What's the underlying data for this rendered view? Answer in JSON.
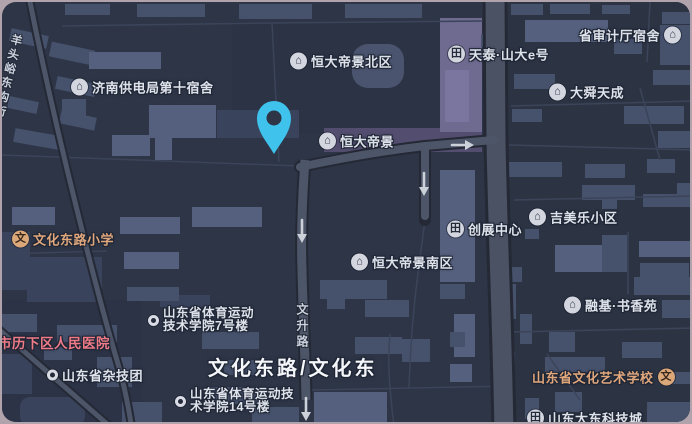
{
  "colors": {
    "frame": "#b1a3ab",
    "map_background": "#2d3547",
    "pin": "#3fc2ec",
    "default_label": "#dee2ea",
    "orange_label": "#e0a77d",
    "pink_label": "#ef7b87"
  },
  "icons": {
    "house": "⌂",
    "building": "田",
    "school": "文"
  },
  "pois": [
    {
      "name": "jinan-power-bureau-dorm",
      "lines": [
        "济南供电局第十宿舍"
      ],
      "icon": "house"
    },
    {
      "name": "hengda-dijing-north",
      "lines": [
        "恒大帝景北区"
      ],
      "icon": "house"
    },
    {
      "name": "tiantai-shanda-e",
      "lines": [
        "天泰·山大e号"
      ],
      "icon": "building"
    },
    {
      "name": "audit-office-dorm",
      "lines": [
        "省审计厅宿舍"
      ],
      "icon": "house",
      "icon_side": "right"
    },
    {
      "name": "dashun-tiancheng",
      "lines": [
        "大舜天成"
      ],
      "icon": "house"
    },
    {
      "name": "hengda-dijing",
      "lines": [
        "恒大帝景"
      ],
      "icon": "house"
    },
    {
      "name": "chuangzhan-center",
      "lines": [
        "创展中心"
      ],
      "icon": "building"
    },
    {
      "name": "jimeile-community",
      "lines": [
        "吉美乐小区"
      ],
      "icon": "house"
    },
    {
      "name": "wenhua-east-road-primary-school",
      "lines": [
        "文化东路小学"
      ],
      "icon": "school",
      "color": "orange"
    },
    {
      "name": "hengda-dijing-south",
      "lines": [
        "恒大帝景南区"
      ],
      "icon": "house"
    },
    {
      "name": "rongji-shuxiangyuan",
      "lines": [
        "融基·书香苑"
      ],
      "icon": "house"
    },
    {
      "name": "lixia-district-peoples-hospital",
      "lines": [
        "市历下区人民医院"
      ],
      "icon": null,
      "color": "pink"
    },
    {
      "name": "sports-institute-building-7",
      "lines": [
        "山东省体育运动",
        "技术学院7号楼"
      ],
      "icon": "dot"
    },
    {
      "name": "shandong-acrobatic-troupe",
      "lines": [
        "山东省杂技团"
      ],
      "icon": "dot"
    },
    {
      "name": "sports-institute-building-14",
      "lines": [
        "山东省体育运动技",
        "术学院14号楼"
      ],
      "icon": "dot"
    },
    {
      "name": "shandong-culture-art-school",
      "lines": [
        "山东省文化艺术学校"
      ],
      "icon": "school",
      "icon_side": "right",
      "color": "orange"
    },
    {
      "name": "shandong-dadong-tech-city",
      "lines": [
        "山东大东科技城"
      ],
      "icon": "building"
    }
  ],
  "road_labels": {
    "vertical_left": "羊头峪东沟街",
    "vertical_center": "文升路",
    "major": "文化东路/文化东"
  }
}
